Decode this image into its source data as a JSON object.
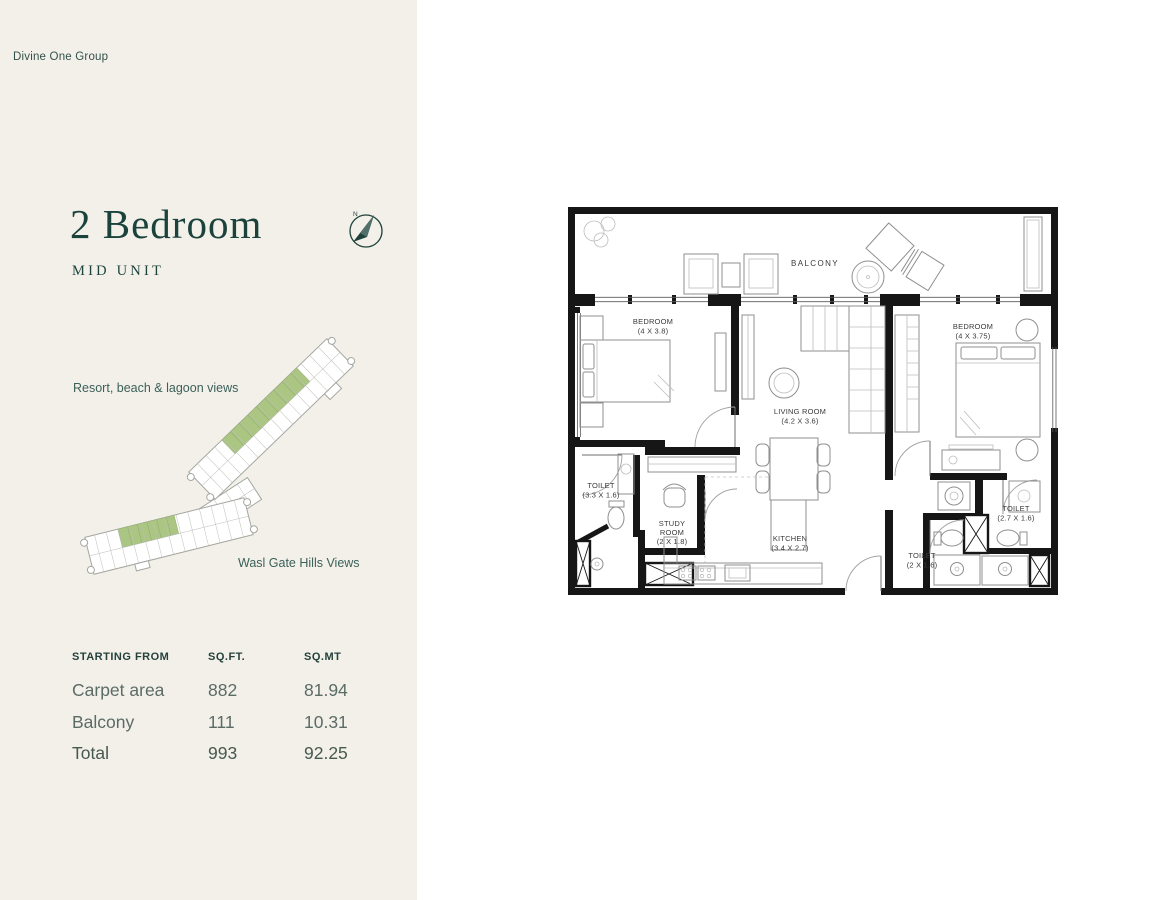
{
  "brand": "Divine One Group",
  "unit": {
    "title": "2 Bedroom",
    "subtitle": "MID UNIT"
  },
  "compass": {
    "north_label": "N"
  },
  "views": {
    "top": "Resort, beach & lagoon views",
    "bottom": "Wasl Gate Hills Views"
  },
  "area_table": {
    "headers": [
      "STARTING FROM",
      "SQ.FT.",
      "SQ.MT"
    ],
    "rows": [
      {
        "label": "Carpet area",
        "sqft": "882",
        "sqmt": "81.94"
      },
      {
        "label": "Balcony",
        "sqft": "111",
        "sqmt": "10.31"
      },
      {
        "label": "Total",
        "sqft": "993",
        "sqmt": "92.25"
      }
    ]
  },
  "floorplan": {
    "rooms": [
      {
        "id": "balcony",
        "label_lines": [
          "BALCONY"
        ]
      },
      {
        "id": "bedroom-1",
        "label_lines": [
          "BEDROOM",
          "(4 X 3.8)"
        ]
      },
      {
        "id": "bedroom-2",
        "label_lines": [
          "BEDROOM",
          "(4 X 3.75)"
        ]
      },
      {
        "id": "living-room",
        "label_lines": [
          "LIVING ROOM",
          "(4.2 X 3.6)"
        ]
      },
      {
        "id": "toilet-1",
        "label_lines": [
          "TOILET",
          "(3.3 X 1.6)"
        ]
      },
      {
        "id": "study-room",
        "label_lines": [
          "STUDY",
          "ROOM",
          "(2 X 1.8)"
        ]
      },
      {
        "id": "kitchen",
        "label_lines": [
          "KITCHEN",
          "(3.4 X 2.7)"
        ]
      },
      {
        "id": "toilet-2",
        "label_lines": [
          "TOILET",
          "(2.7 X 1.6)"
        ]
      },
      {
        "id": "toilet-3",
        "label_lines": [
          "TOILET",
          "(2 X 1.6)"
        ]
      }
    ]
  },
  "colors": {
    "panel_bg": "#f3f0ea",
    "accent_teal": "#1c423c",
    "highlight_green": "#abc682",
    "wall": "#161616"
  }
}
